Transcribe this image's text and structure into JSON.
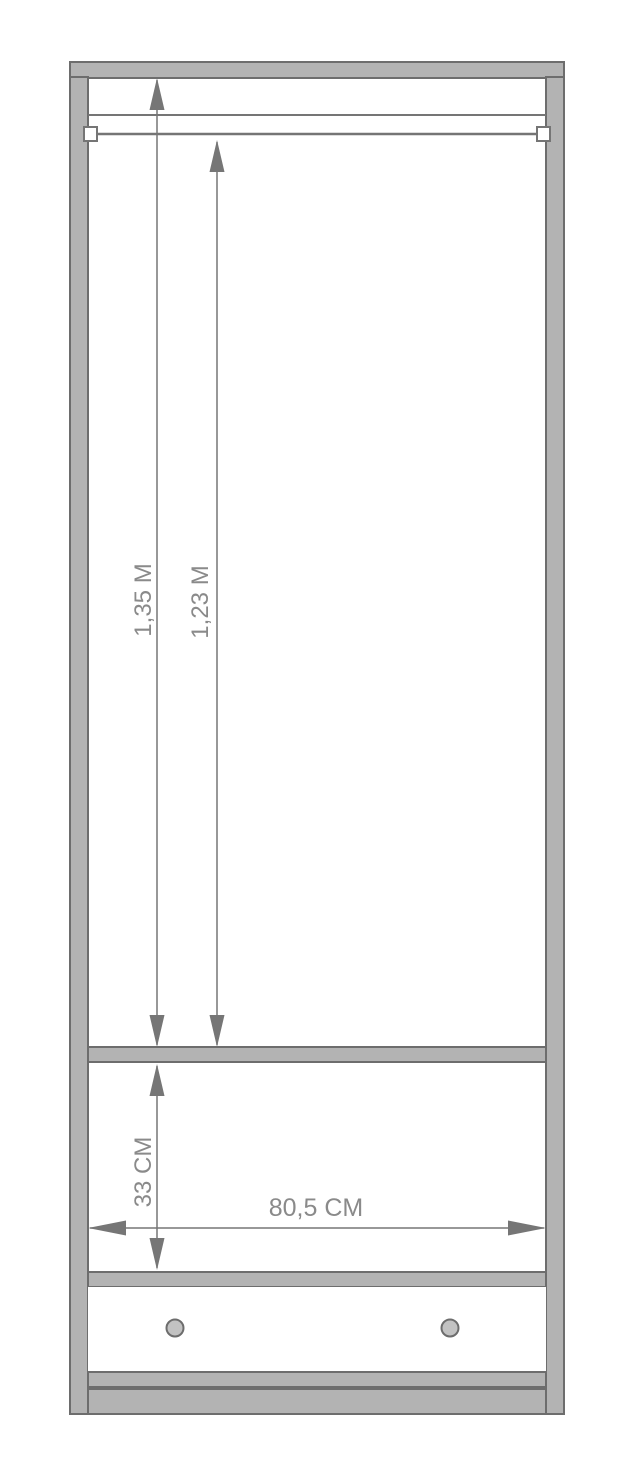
{
  "diagram": {
    "subject": "wardrobe-dimension-drawing",
    "labels": {
      "inner_height": "1,35 M",
      "rail_height": "1,23 M",
      "drawer_section_height": "33 CM",
      "inner_width": "80,5 CM"
    },
    "colors": {
      "background": "#ffffff",
      "panel_fill": "#b3b3b3",
      "panel_outline": "#6d6d6d",
      "dimension_line": "#767676",
      "label_text": "#8a8a8a",
      "bracket_fill": "#ffffff",
      "knob_fill": "#c2c2c2"
    }
  }
}
